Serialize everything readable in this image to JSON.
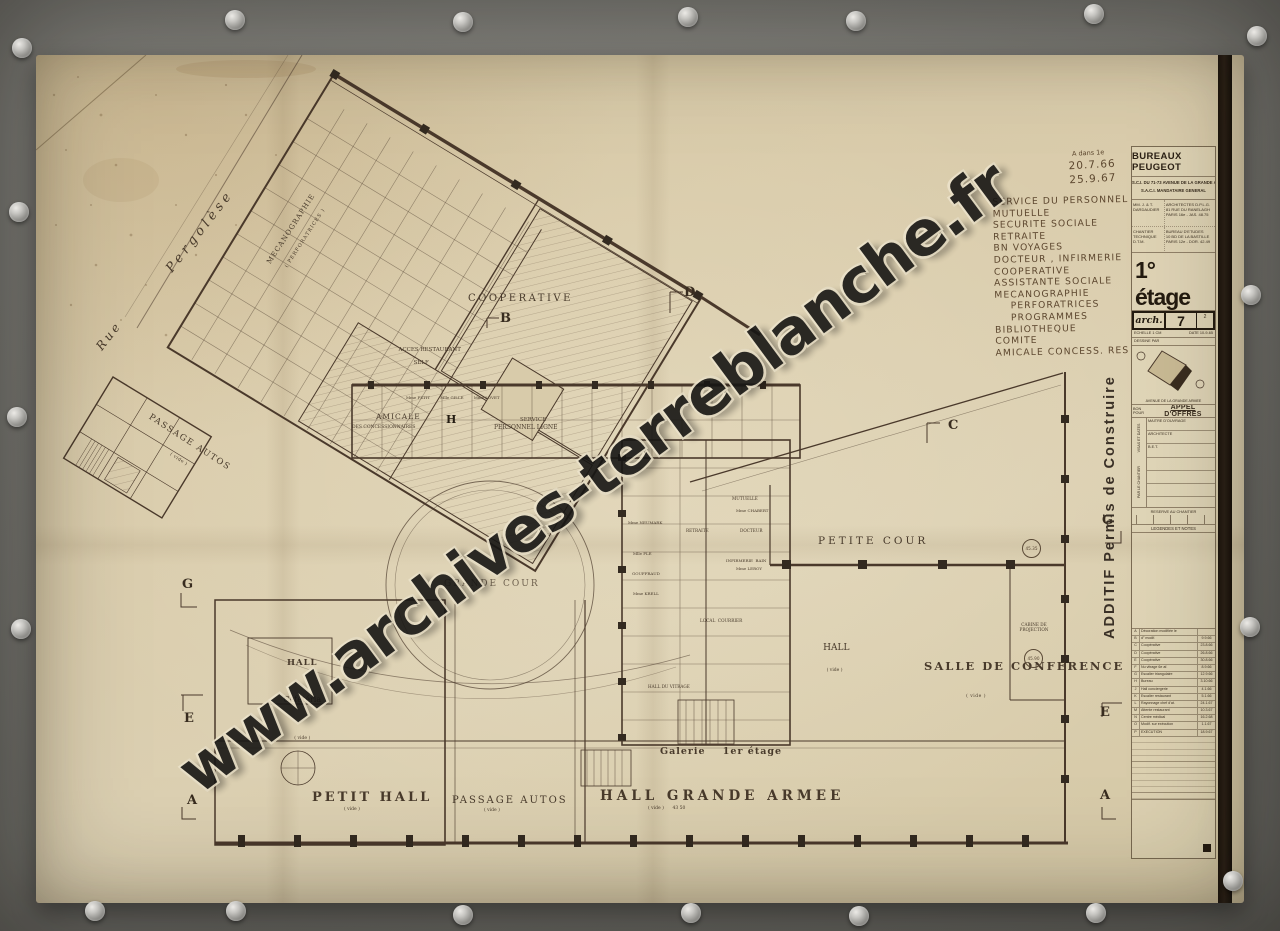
{
  "watermark": "www.archives-terreblanche.fr",
  "annotations": {
    "note": "A dans 1e",
    "date1": "20.7.66",
    "date2": "25.9.67",
    "list": [
      "SERVICE DU PERSONNEL",
      "MUTUELLE",
      "SECURITE SOCIALE",
      "RETRAITE",
      "BN VOYAGES",
      "DOCTEUR , INFIRMERIE",
      "COOPERATIVE",
      "ASSISTANTE SOCIALE",
      "MECANOGRAPHIE",
      "    PERFORATRICES",
      "    PROGRAMMES",
      "BIBLIOTHEQUE",
      "COMITE",
      "AMICALE CONCESS. RES"
    ]
  },
  "plan": {
    "streets": {
      "rue": "Rue",
      "pergolese": "Pergolèse"
    },
    "labels": {
      "passage_autos_upper": "PASSAGE AUTOS",
      "vide": "( vide )",
      "cooperative": "COOPERATIVE",
      "mecanographie": "MECANOGRAPHIE",
      "perforatrices": "( PERFORATRICES )",
      "acces_restaurant": "ACCES RESTAURANT",
      "self": "SELF",
      "amicale": "AMICALE",
      "concessionnaires": "DES CONCESSIONNAIRES",
      "service": "SERVICE",
      "personnel_ligne": "PERSONNEL LIGNE",
      "grande_cour": "GRANDE COUR",
      "petite_cour": "PETITE COUR",
      "hall": "HALL",
      "salle_conference": "SALLE DE CONFERENCE",
      "cabine_projection": "CABINE DE\nPROJECTION",
      "hall_cafeteria_line1": "HALL",
      "hall_cafeteria_line2": "Cafétéria",
      "petit_hall": "PETIT HALL",
      "passage_autos_lower": "PASSAGE AUTOS",
      "hall_grande_armee": "HALL GRANDE ARMEE",
      "hall_ga_sub": "( vide )      43 50",
      "galerie": "Galerie    1er étage",
      "hall_du_vitrage": "HALL DU VITRAGE",
      "local_courrier": "LOCAL  COURRIER",
      "retraite": "RETRAITE",
      "mutuelle": "MUTUELLE",
      "docteur": "DOCTEUR",
      "infirmerie": "INFIRMERIE  BAIN",
      "mme_chabert": "Mme CHABERT",
      "mme_leroy": "Mme LEROY",
      "mme_neumark": "Mme NEUMARK",
      "mlle_ple": "Mlle PLE",
      "gouffraud": "GOUFFRAUD",
      "mme_krell": "Mme KRELL",
      "names_row": "Mme PETIT        Mlle GILLE        Mme LOVET",
      "level_4535": "45.35",
      "level_4590": "45.90"
    },
    "markers": {
      "a": "A",
      "b": "B",
      "c": "C",
      "d": "D",
      "e": "E",
      "g": "G",
      "h": "H"
    }
  },
  "title_block": {
    "project": "BUREAUX PEUGEOT",
    "owner_line1": "S.C.I. DU 71-73 AVENUE DE LA GRANDE ARMEE",
    "owner_line2": "S.A.C.I.  MANDATAIRE GENERAL",
    "arch_name": "MM. J. & T. DARDAUDIER",
    "arch_info": "ARCHITECTES D.P.L.G.\n81 RUE DU RANELAGH\nPARIS 16e - JAS. 48.75",
    "bet_name": "CHANTIER TECHNIQUE\nD.T.M.",
    "bet_info": "BUREAU D'ETUDES\n10 BD DE LA BASTILLE\nPARIS 12e - DOR. 42.49",
    "floor": "1° étage",
    "niveau_label": "NIVEAU",
    "niveau_value": "45.20",
    "arch_label": "arch.",
    "arch_number": "7",
    "arch_indice": "2",
    "echelle": "ECHELLE  1 CM",
    "date": "DATE  10-9-65",
    "dessine": "DESSINE PAR",
    "site_caption": "AVENUE DE LA GRANDE ARMEE",
    "bon_pour": "BON POUR",
    "appel": "APPEL D'OFFRES",
    "visas_label1": "VISAS ET DATES",
    "visas_label2": "PAR LE CHANTIER",
    "visas_rows": [
      "MAITRE D'OUVRAGE",
      "ARCHITECTE",
      "B.E.T.",
      "",
      "",
      "",
      "",
      ""
    ],
    "reserve": "RESERVE AU CHANTIER",
    "legendes": "LEGENDES ET NOTES",
    "additif": "ADDITIF   Permis  de  Construire",
    "revisions": [
      {
        "l": "A",
        "d": "Décoration modifiée le",
        "t": ""
      },
      {
        "l": "B",
        "d": "d° modif.",
        "t": "9.9.66"
      },
      {
        "l": "C",
        "d": "Coopérative",
        "t": "23.8.66"
      },
      {
        "l": "D",
        "d": "Coopérative",
        "t": "26.8.66"
      },
      {
        "l": "E",
        "d": "Coopérative",
        "t": "30.8.66"
      },
      {
        "l": "F",
        "d": "Nu vitrage 6e af.",
        "t": "8.9.66"
      },
      {
        "l": "G",
        "d": "Escalier triangulaire",
        "t": "12.9.66"
      },
      {
        "l": "H",
        "d": "Bureau",
        "t": "3.10.66"
      },
      {
        "l": "J",
        "d": "Hall conciergerie",
        "t": "4.1.66"
      },
      {
        "l": "K",
        "d": "Escalier restaurant",
        "t": "5.1.66"
      },
      {
        "l": "L",
        "d": "Rayonnage chef d'at.",
        "t": "24.1.67"
      },
      {
        "l": "M",
        "d": "Attente restaurant",
        "t": "10.3.67"
      },
      {
        "l": "N",
        "d": "Centre médical",
        "t": "16.2.68"
      },
      {
        "l": "O",
        "d": "Modif. sur exécution",
        "t": "1.1.67"
      },
      {
        "l": "P",
        "d": "EXECUTION",
        "t": "18.9.67"
      }
    ]
  }
}
